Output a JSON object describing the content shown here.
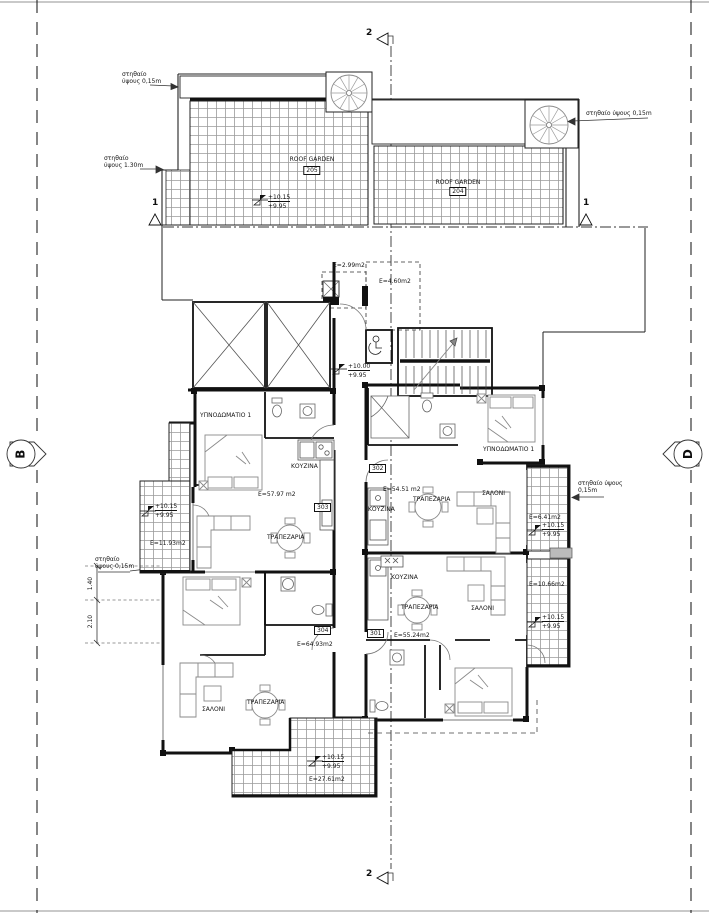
{
  "colors": {
    "wall": "#111111",
    "hatch_line": "#9a9a9a",
    "furniture_line": "#8a8a8a"
  },
  "grid_markers": {
    "left": "B",
    "right": "D"
  },
  "section_markers": {
    "vertical_top": "2",
    "vertical_bottom": "2",
    "horizontal_left": "1",
    "horizontal_right": "1"
  },
  "parapets": {
    "top_left_l1": "στηθαίο",
    "top_left_l2": "ύψους 0,15m",
    "left_high_l1": "στηθαίο",
    "left_high_l2": "ύψους 1.30m",
    "top_right": "στηθαίο ύψους 0,15m",
    "mid_left_l1": "στηθαίο",
    "mid_left_l2": "ύψους 0,15m",
    "mid_right_l1": "στηθαίο ύψους",
    "mid_right_l2": "0,15m"
  },
  "roof_gardens": {
    "left": {
      "label": "ROOF GARDEN",
      "number": "205",
      "level_top": "+10.15",
      "level_bottom": "+9.95"
    },
    "right": {
      "label": "ROOF GARDEN",
      "number": "204"
    }
  },
  "entrance": {
    "area_small": "E=2.99m2",
    "area_canopy": "E=4.60m2",
    "level_top": "+10.00",
    "level_bottom": "+9.95"
  },
  "units": {
    "u303": {
      "number": "303",
      "area": "E=57.97 m2",
      "bedroom": "ΥΠΝΟΔΩΜΑΤΙΟ 1",
      "kitchen": "ΚΟΥΖΙΝΑ",
      "dining": "ΤΡΑΠΕΖΑΡΙΑ"
    },
    "u302": {
      "number": "302",
      "area": "E=54.51 m2",
      "bedroom": "ΥΠΝΟΔΩΜΑΤΙΟ 1",
      "kitchen": "ΚΟΥΖΙΝΑ",
      "dining": "ΤΡΑΠΕΖΑΡΙΑ",
      "living": "ΣΑΛΟΝΙ"
    },
    "u301": {
      "number": "301",
      "area": "E=55.24m2",
      "kitchen": "ΚΟΥΖΙΝΑ",
      "dining": "ΤΡΑΠΕΖΑΡΙΑ",
      "living": "ΣΑΛΟΝΙ"
    },
    "u304": {
      "number": "304",
      "area": "E=64.93m2",
      "dining": "ΤΡΑΠΕΖΑΡΙΑ",
      "living": "ΣΑΛΟΝΙ"
    }
  },
  "balconies": {
    "left": {
      "area": "E=11.93m2",
      "level_top": "+10.15",
      "level_bottom": "+9.95"
    },
    "right_upper": {
      "area": "E=6.41m2",
      "level_top": "+10.15",
      "level_bottom": "+9.95"
    },
    "right_lower": {
      "area": "E=10.66m2",
      "level_top": "+10.15",
      "level_bottom": "+9.95"
    },
    "bottom": {
      "area": "E=27.61m2",
      "level_top": "+10.15",
      "level_bottom": "+9.95"
    }
  },
  "dimensions": {
    "left_upper": "1.40",
    "left_lower": "2.10"
  }
}
